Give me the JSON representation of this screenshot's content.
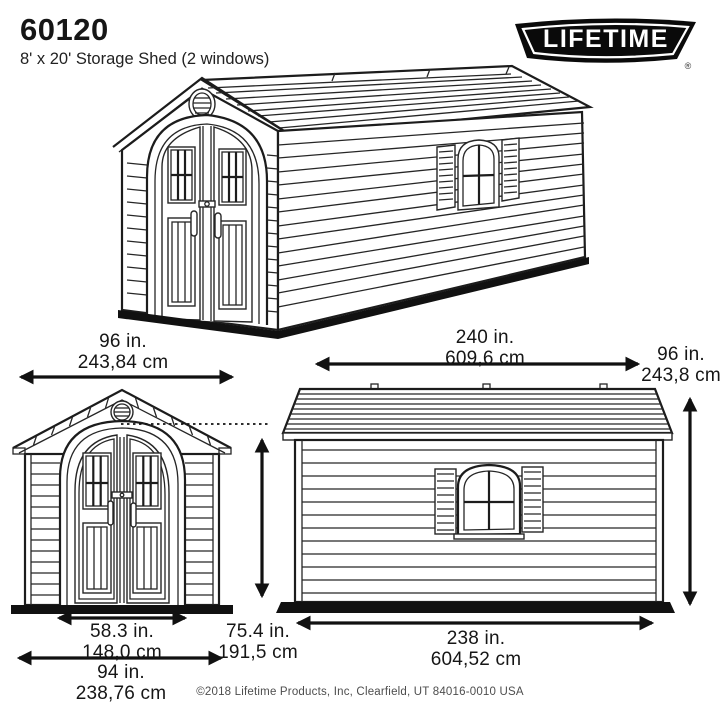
{
  "header": {
    "model_number": "60120",
    "product_name": "8' x 20' Storage Shed (2 windows)",
    "brand": "LIFETIME",
    "registered_mark": "®"
  },
  "dimensions": {
    "front_width": {
      "inches": "96 in.",
      "cm": "243,84 cm"
    },
    "side_length": {
      "inches": "240 in.",
      "cm": "609,6 cm"
    },
    "height": {
      "inches": "96 in.",
      "cm": "243,8 cm"
    },
    "door_opening_width": {
      "inches": "58.3 in.",
      "cm": "148,0 cm"
    },
    "door_opening_height": {
      "inches": "75.4 in.",
      "cm": "191,5 cm"
    },
    "front_base_width": {
      "inches": "94 in.",
      "cm": "238,76 cm"
    },
    "side_base_length": {
      "inches": "238 in.",
      "cm": "604,52 cm"
    }
  },
  "footer": {
    "copyright": "©2018 Lifetime Products, Inc, Clearfield, UT 84016-0010 USA"
  },
  "colors": {
    "line": "#1c1c1c",
    "background": "#ffffff",
    "logo_background": "#0a0a0a",
    "logo_text": "#ffffff"
  }
}
